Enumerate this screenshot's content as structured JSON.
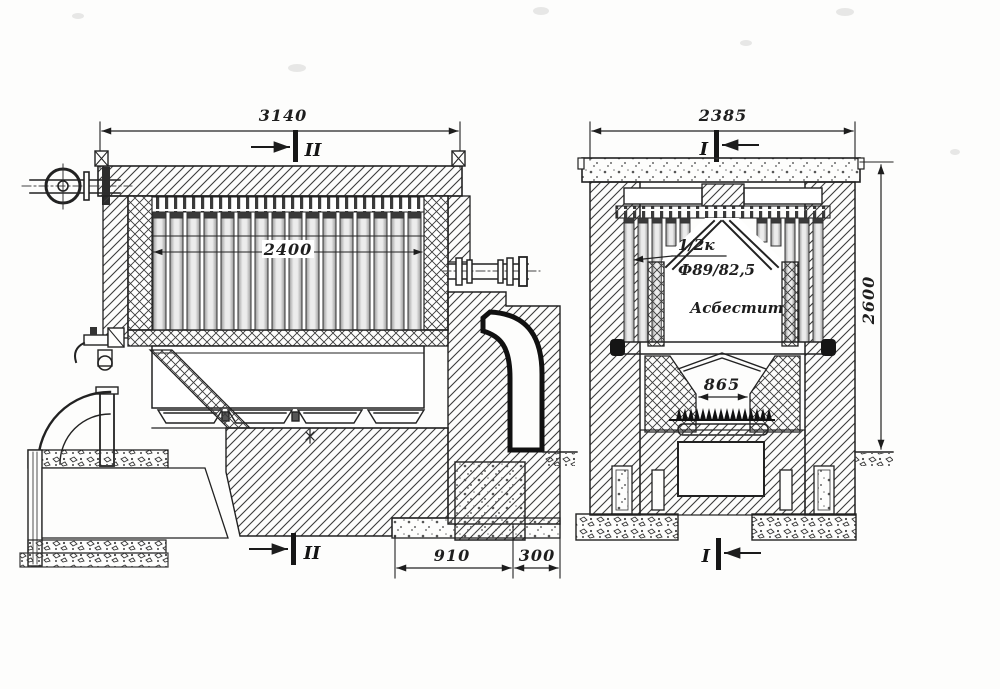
{
  "style": {
    "ink": "#222222",
    "paper": "#fdfdfc"
  },
  "left_view": {
    "name": "longitudinal-section",
    "section_label_top": "II",
    "section_label_bottom": "II",
    "dims": {
      "overall_width": "3140",
      "tube_bundle_width": "2400",
      "foundation_width": "910",
      "foundation_step": "300"
    }
  },
  "right_view": {
    "name": "transverse-section",
    "section_label_top": "I",
    "section_label_bottom": "I",
    "dims": {
      "overall_width": "2385",
      "overall_height": "2600",
      "grate_opening": "865"
    },
    "notes": {
      "tube_note": "1/2к",
      "tube_size": "Ф89/82,5",
      "insulation": "Асбестит"
    }
  }
}
